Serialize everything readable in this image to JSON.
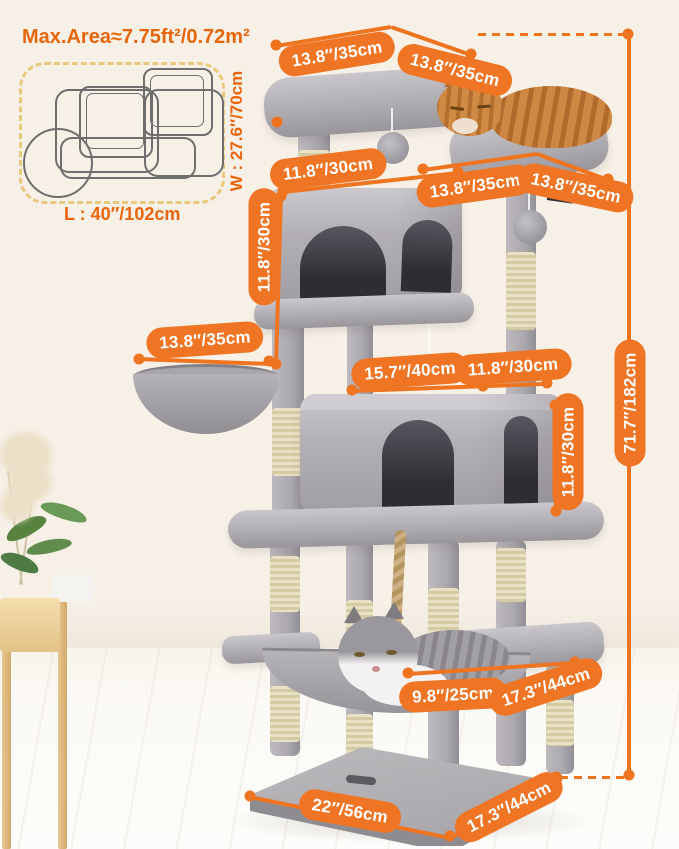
{
  "info_panel": {
    "max_area": "Max.Area≈7.75ft²/0.72m²",
    "length_label": "L : 40″/102cm",
    "width_label": "W : 27.6″/70cm"
  },
  "dimensions": {
    "top_platform_length": "13.8″/35cm",
    "top_platform_width": "13.8″/35cm",
    "upper_shelf_length": "11.8″/30cm",
    "perch_length": "13.8″/35cm",
    "perch_width": "13.8″/35cm",
    "upper_condo_height": "11.8″/30cm",
    "basket_diameter": "13.8″/35cm",
    "lower_condo_length": "15.7″/40cm",
    "lower_condo_width": "11.8″/30cm",
    "lower_condo_height": "11.8″/30cm",
    "total_height": "71.7″/182cm",
    "hammock_width": "9.8″/25cm",
    "mid_platform_length": "17.3″/44cm",
    "base_length": "22″/56cm",
    "base_width": "17.3″/44cm"
  },
  "colors": {
    "accent_orange": "#EE7420",
    "dashed_box_gold": "#E9C97E",
    "plush_gray": "#B0ADB2",
    "sisal_beige": "#DFD6B4"
  }
}
